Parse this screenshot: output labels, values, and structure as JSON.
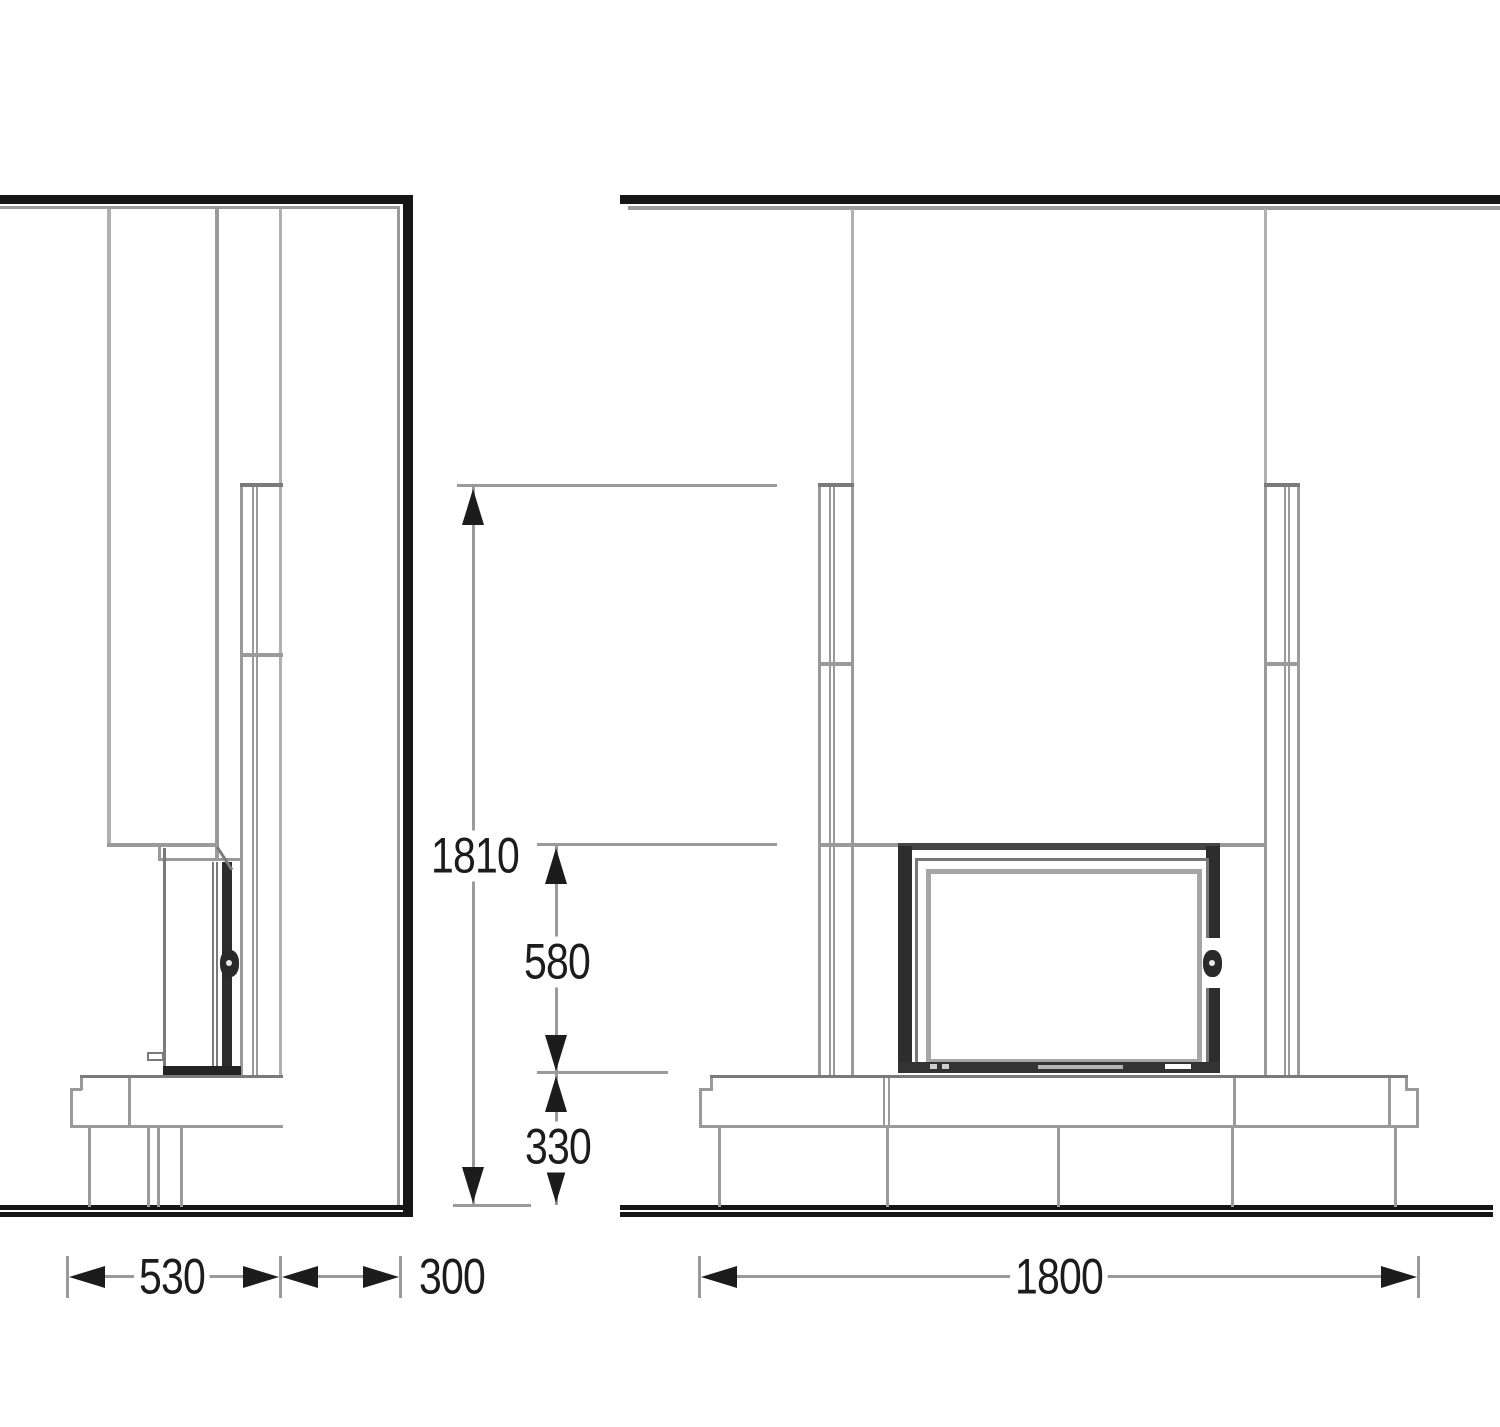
{
  "dimensions": {
    "side": {
      "bench_depth": "530",
      "column_depth": "300"
    },
    "front": {
      "bench_width": "1800"
    },
    "heights": {
      "total": "1810",
      "opening": "580",
      "base": "330"
    }
  },
  "colors": {
    "background": "#ffffff",
    "line": "#9a9a9a",
    "line_light": "#b0b0b0",
    "line_dark": "#7a7a7a",
    "structure": "#161616",
    "insert_frame": "#2d2d2d",
    "text": "#1c1c1c"
  }
}
